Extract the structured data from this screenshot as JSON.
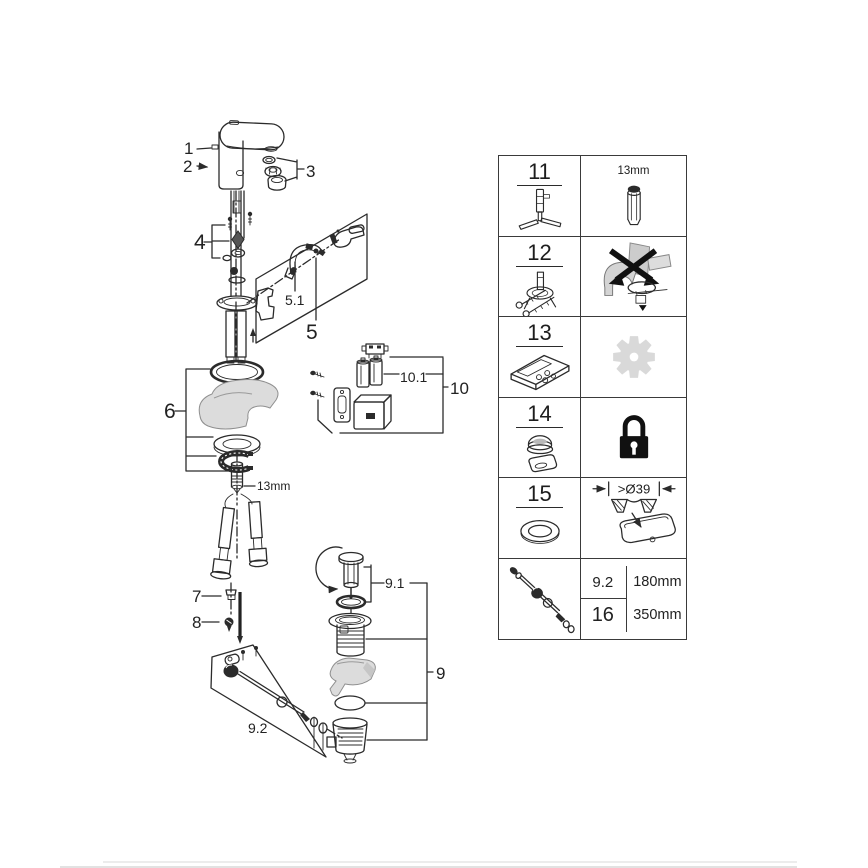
{
  "diagram": {
    "labels": {
      "p1": "1",
      "p2": "2",
      "p3": "3",
      "p4": "4",
      "p5": "5",
      "p5_1": "5.1",
      "p6": "6",
      "p7": "7",
      "p8": "8",
      "p9": "9",
      "p9_1": "9.1",
      "p9_2": "9.2",
      "p10": "10",
      "p10_1": "10.1",
      "stud_size": "13mm"
    }
  },
  "parts_table": {
    "rows": [
      {
        "ref": "11",
        "right_label": "13mm"
      },
      {
        "ref": "12"
      },
      {
        "ref": "13"
      },
      {
        "ref": "14"
      },
      {
        "ref": "15",
        "right_label": ">Ø39"
      },
      {
        "variants": [
          {
            "ref": "9.2",
            "length": "180mm"
          },
          {
            "ref": "16",
            "length": "350mm"
          }
        ]
      }
    ]
  },
  "colors": {
    "line": "#2b2b2b",
    "gray_fill": "#d9d9d9"
  }
}
